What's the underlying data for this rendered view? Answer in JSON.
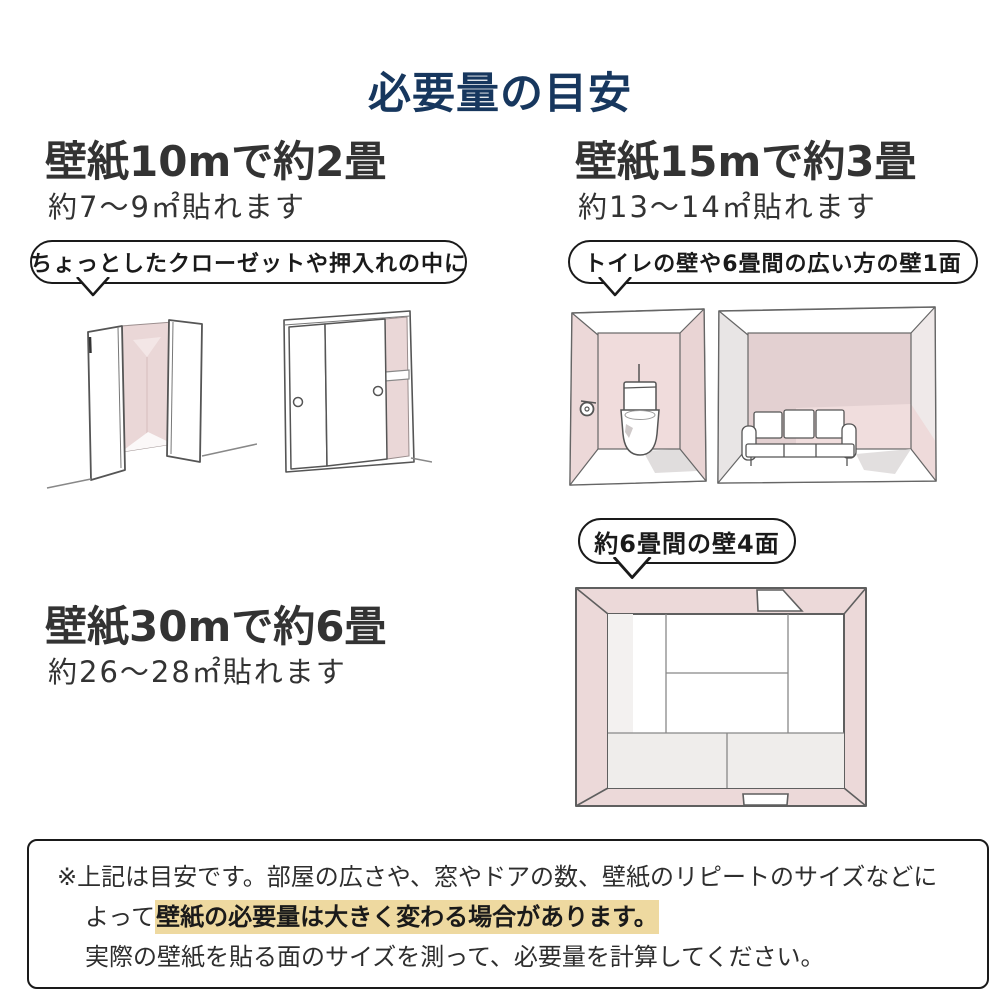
{
  "title": "必要量の目安",
  "sections": {
    "s10m": {
      "heading": "壁紙10mで約2畳",
      "sub": "約7〜9㎡貼れます",
      "bubble": "ちょっとしたクローゼットや押入れの中に"
    },
    "s15m": {
      "heading": "壁紙15mで約3畳",
      "sub": "約13〜14㎡貼れます",
      "bubble": "トイレの壁や6畳間の広い方の壁1面"
    },
    "s30m": {
      "heading": "壁紙30mで約6畳",
      "sub": "約26〜28㎡貼れます",
      "bubble": "約6畳間の壁4面"
    }
  },
  "note": {
    "line1": "※上記は目安です。部屋の広さや、窓やドアの数、壁紙のリピートのサイズなどに",
    "line2_prefix": "よって",
    "line2_highlight": "壁紙の必要量は大きく変わる場合があります。",
    "line3": "実際の壁紙を貼る面のサイズを測って、必要量を計算してください。"
  },
  "illustrations": {
    "closet_open": "open-closet-interior",
    "closet_sliding": "sliding-door-closet",
    "toilet": "toilet-room-perspective",
    "living": "six-mat-room-wide-wall",
    "tatami_top": "six-mat-room-four-walls-top-view"
  },
  "palette": {
    "title_navy": "#17375e",
    "text_dark": "#333333",
    "wall_pink": "#ecd8d8",
    "wall_pink_light": "#f0dddd",
    "wall_mauve": "#e3d0d1",
    "wall_gray": "#e8e5e5",
    "highlight_yellow": "#eed9a0",
    "line_gray": "#5f5f5f"
  }
}
